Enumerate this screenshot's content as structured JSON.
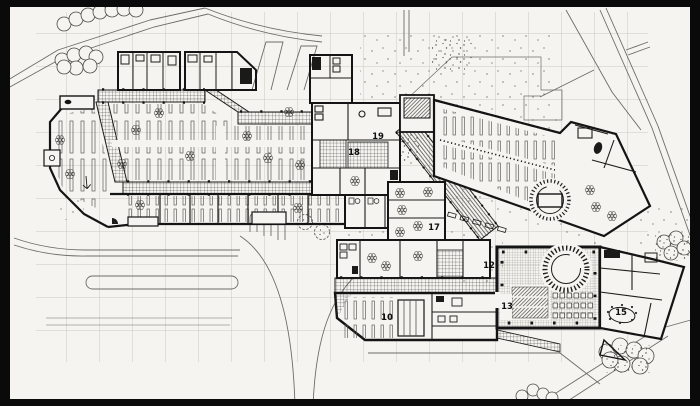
{
  "page": {
    "type": "architectural site / floor plan scan",
    "sheet_background": "#f5f4f0",
    "frame_color": "#0a0a0a",
    "ink_color": "#141414",
    "grid_color": "#cbc8c1"
  },
  "plan": {
    "area_labels": [
      {
        "text": "10",
        "x": 387,
        "y": 320
      },
      {
        "text": "12",
        "x": 489,
        "y": 268
      },
      {
        "text": "13",
        "x": 507,
        "y": 309
      },
      {
        "text": "15",
        "x": 621,
        "y": 315
      },
      {
        "text": "17",
        "x": 434,
        "y": 230
      },
      {
        "text": "18",
        "x": 354,
        "y": 155
      },
      {
        "text": "19",
        "x": 378,
        "y": 139
      }
    ]
  }
}
